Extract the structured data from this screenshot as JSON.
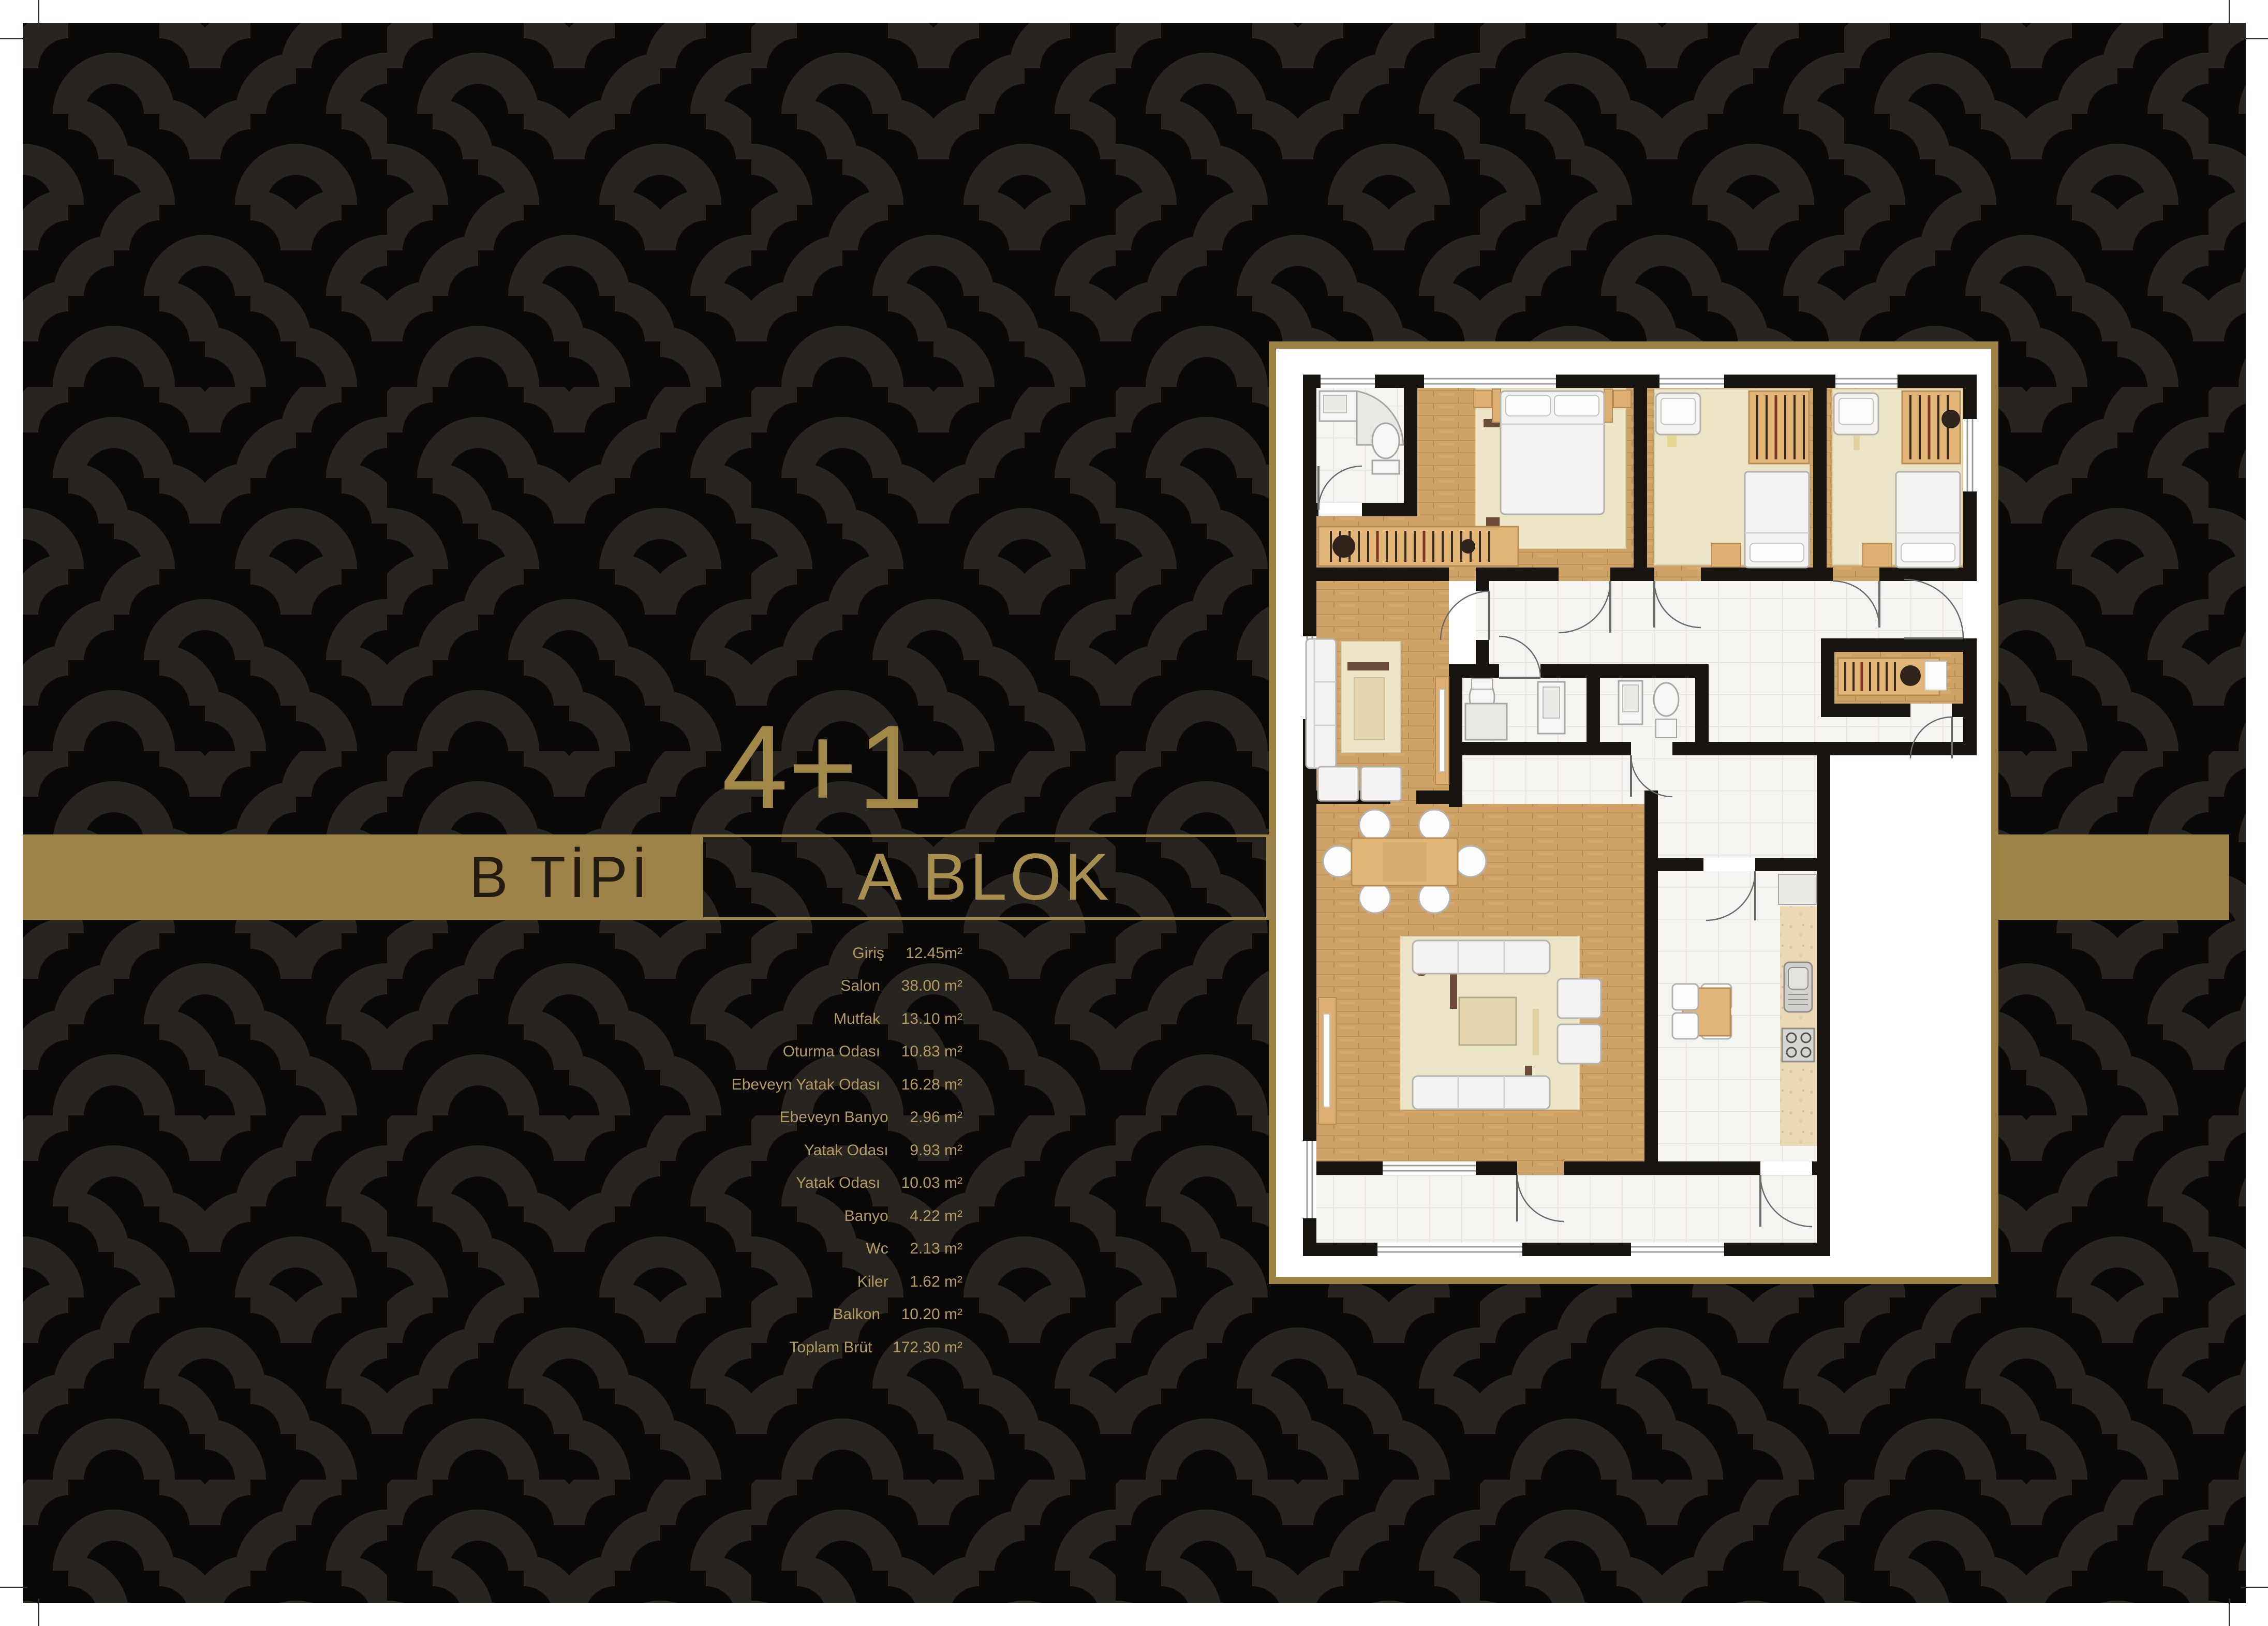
{
  "page": {
    "unit_label": "4+1",
    "type_label": "B TİPİ",
    "block_label": "A BLOK"
  },
  "area_table": {
    "rows": [
      {
        "label": "Giriş",
        "area": "12.45m²"
      },
      {
        "label": "Salon",
        "area": "38.00 m²"
      },
      {
        "label": "Mutfak",
        "area": "13.10 m²"
      },
      {
        "label": "Oturma Odası",
        "area": "10.83 m²"
      },
      {
        "label": "Ebeveyn Yatak Odası",
        "area": "16.28 m²"
      },
      {
        "label": "Ebeveyn Banyo",
        "area": "2.96 m²"
      },
      {
        "label": "Yatak Odası",
        "area": "9.93 m²"
      },
      {
        "label": "Yatak Odası",
        "area": "10.03 m²"
      },
      {
        "label": "Banyo",
        "area": "4.22 m²"
      },
      {
        "label": "Wc",
        "area": "2.13 m²"
      },
      {
        "label": "Kiler",
        "area": "1.62 m²"
      },
      {
        "label": "Balkon",
        "area": "10.20 m²"
      },
      {
        "label": "Toplam Brüt",
        "area": "172.30 m²"
      }
    ]
  },
  "floor_plan": {
    "kind": "apartment-floor-plan",
    "rooms": [
      "Giriş",
      "Salon",
      "Mutfak",
      "Oturma Odası",
      "Ebeveyn Yatak Odası",
      "Ebeveyn Banyo",
      "Yatak Odası",
      "Yatak Odası",
      "Banyo",
      "Wc",
      "Kiler",
      "Balkon"
    ]
  },
  "colors": {
    "gold": "#9d8347",
    "gold_text_bright": "#a98f4f",
    "list_text": "#b39a62",
    "band_text_dark": "#241c10",
    "pattern_bg": "#0b0907",
    "pattern_swirl": "#282420",
    "plan_wall": "#18140f",
    "wood": "#cfa267",
    "rug": "#ece4c6",
    "tile": "#f5f4f1"
  },
  "pattern": {
    "cells": "ABAA BBAB AABA ABBB"
  }
}
